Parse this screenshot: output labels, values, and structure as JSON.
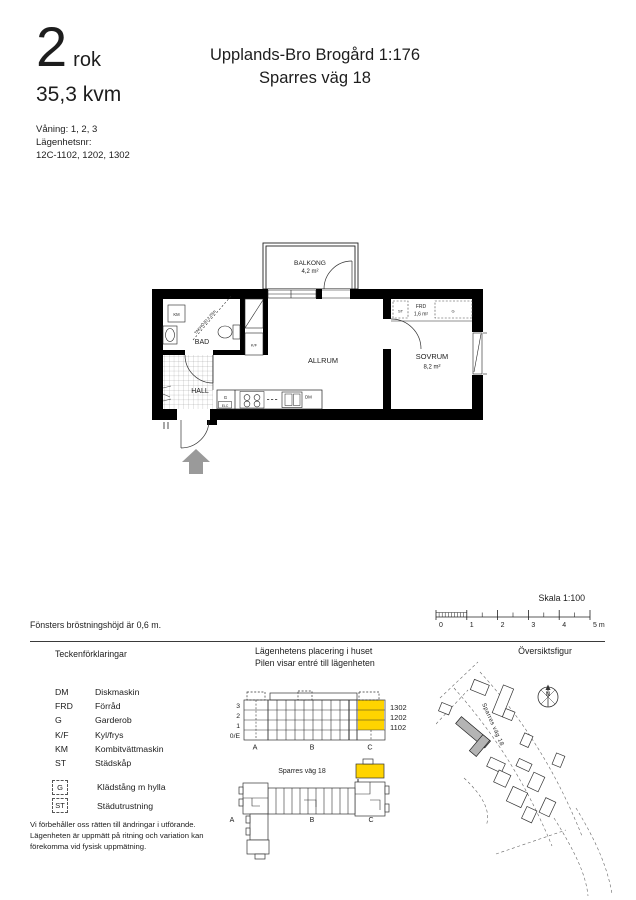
{
  "header": {
    "rooms_number": "2",
    "rooms_suffix": "rok",
    "area": "35,3 kvm",
    "floors_line": "Våning: 1, 2, 3",
    "apartment_label": "Lägenhetsnr:",
    "apartment_numbers": "12C-1102, 1202, 1302",
    "title_line1": "Upplands-Bro Brogård 1:176",
    "title_line2": "Sparres väg 18"
  },
  "floorplan": {
    "balcony_name": "BALKONG",
    "balcony_area": "4,2 m²",
    "bathroom_name": "BAD",
    "ceiling_height_note": "TAKHÖJD 2,25m",
    "washer_label": "KM",
    "fridge_label": "K/F",
    "hall_name": "HALL",
    "living_room_name": "ALLRUM",
    "bedroom_name": "SOVRUM",
    "bedroom_area": "8,2 m²",
    "storage_name": "FRD",
    "storage_area": "1,6 m²",
    "cleaning_label": "ST",
    "wardrobe_label": "G",
    "kitchen_cabinet_label": "G",
    "kitchen_elc_label": "ELC",
    "dishwasher_label": "DM"
  },
  "scale": {
    "label": "Skala 1:100",
    "ticks": [
      "0",
      "1",
      "2",
      "3",
      "4",
      "5 m"
    ]
  },
  "notes": {
    "window_sill": "Fönsters bröstningshöjd är 0,6 m."
  },
  "legend": {
    "title": "Teckenförklaringar",
    "items": [
      {
        "abbr": "DM",
        "label": "Diskmaskin"
      },
      {
        "abbr": "FRD",
        "label": "Förråd"
      },
      {
        "abbr": "G",
        "label": "Garderob"
      },
      {
        "abbr": "K/F",
        "label": "Kyl/frys"
      },
      {
        "abbr": "KM",
        "label": "Kombitvättmaskin"
      },
      {
        "abbr": "ST",
        "label": "Städskåp"
      }
    ],
    "boxed_items": [
      {
        "abbr": "G",
        "label": "Klädstång m hylla"
      },
      {
        "abbr": "ST",
        "label": "Städutrustning"
      }
    ]
  },
  "placement": {
    "title_line1": "Lägenhetens placering i huset",
    "title_line2": "Pilen visar entré till lägenheten",
    "floors": [
      "3",
      "2",
      "1",
      "0/E"
    ],
    "apartment_numbers": [
      "1302",
      "1202",
      "1102"
    ],
    "sections": [
      "A",
      "B",
      "C"
    ],
    "street_label": "Sparres väg 18",
    "highlight_color": "#ffd400"
  },
  "overview": {
    "title": "Översiktsfigur",
    "compass_label": "N",
    "street_label": "Sparres väg 18"
  },
  "disclaimer": {
    "line1": "Vi förbehåller oss rätten till ändringar i utförande.",
    "line2": "Lägenheten är uppmätt på ritning och variation kan",
    "line3": "förekomma vid fysisk uppmätning."
  }
}
